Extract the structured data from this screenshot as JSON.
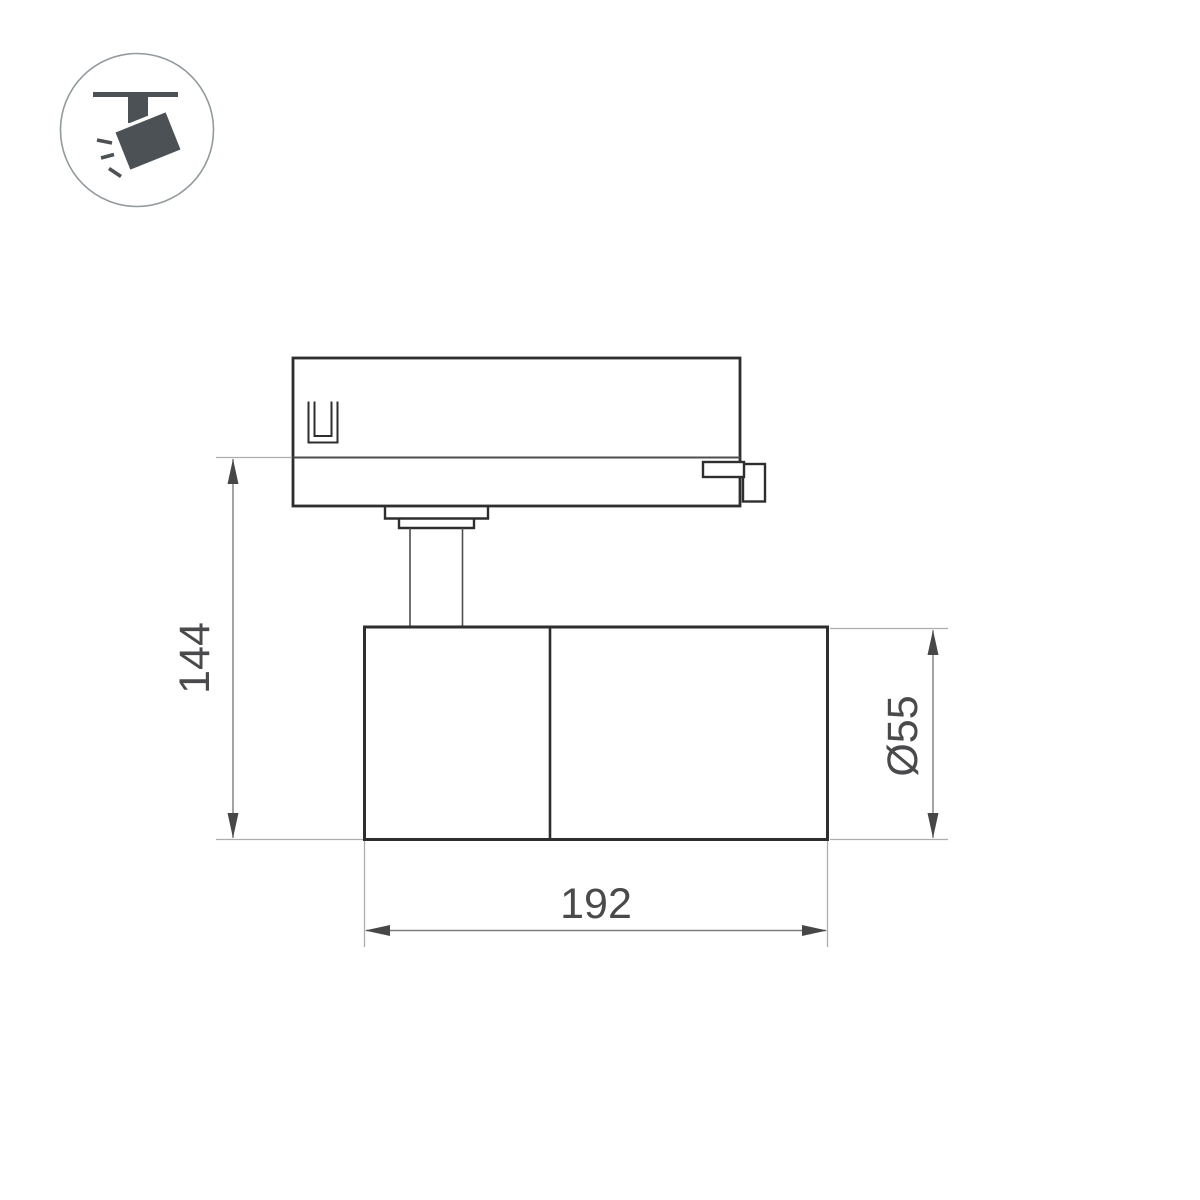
{
  "drawing": {
    "title": "track-spotlight-dimension-drawing",
    "dimensions": {
      "height": "144",
      "length": "192",
      "diameter": "Ø55"
    }
  },
  "icon": {
    "name": "ceiling-track-spotlight-pictogram"
  },
  "colors": {
    "background": "#ffffff",
    "outline": "#2e2e2e",
    "secondary_line": "#4d4d4d",
    "extension_line": "#adadad",
    "dimension_line": "#7d7d7d",
    "arrow": "#474747",
    "label_text": "#4a4a4c",
    "icon": "#4b5154",
    "icon_circle": "#939a9e"
  }
}
